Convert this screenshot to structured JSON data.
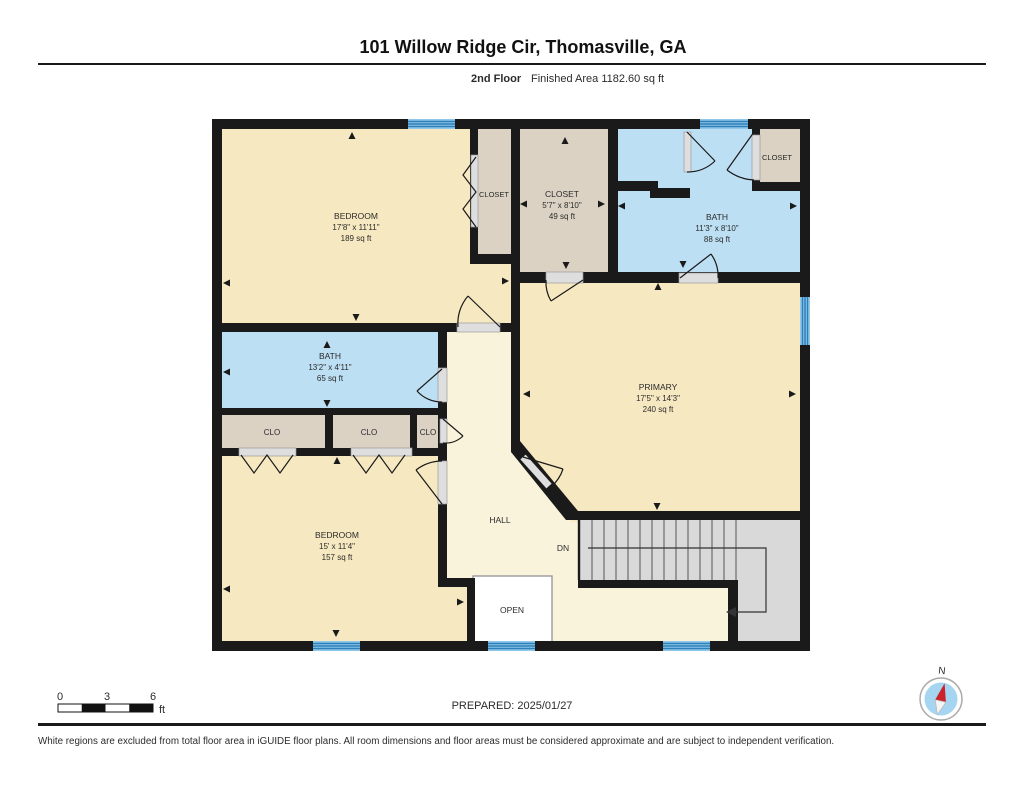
{
  "header": {
    "title": "101 Willow Ridge Cir, Thomasville, GA",
    "floor_label": "2nd Floor",
    "area_label": "Finished Area 1182.60 sq ft"
  },
  "rooms": {
    "bedroom1": {
      "name": "BEDROOM",
      "dims": "17'8\" x 11'11\"",
      "area": "189 sq ft"
    },
    "closet1": {
      "name": "CLOSET"
    },
    "closet2": {
      "name": "CLOSET",
      "dims": "5'7\" x 8'10\"",
      "area": "49 sq ft"
    },
    "bath1": {
      "name": "BATH",
      "dims": "11'3\" x 8'10\"",
      "area": "88 sq ft"
    },
    "closet3": {
      "name": "CLOSET"
    },
    "bath2": {
      "name": "BATH",
      "dims": "13'2\" x 4'11\"",
      "area": "65 sq ft"
    },
    "clo1": {
      "name": "CLO"
    },
    "clo2": {
      "name": "CLO"
    },
    "clo3": {
      "name": "CLO"
    },
    "primary": {
      "name": "PRIMARY",
      "dims": "17'5\" x 14'3\"",
      "area": "240 sq ft"
    },
    "bedroom2": {
      "name": "BEDROOM",
      "dims": "15' x 11'4\"",
      "area": "157 sq ft"
    },
    "hall": {
      "name": "HALL"
    },
    "open": {
      "name": "OPEN"
    },
    "stairs": {
      "label": "DN"
    }
  },
  "scale_bar": {
    "tick0": "0",
    "tick1": "3",
    "tick2": "6",
    "unit": "ft"
  },
  "prepared": "PREPARED: 2025/01/27",
  "compass": {
    "label": "N"
  },
  "footer": "White regions are excluded from total floor area in iGUIDE floor plans. All room dimensions and floor areas must be considered approximate and are subject to independent verification.",
  "colors": {
    "wall": "#1a1a1a",
    "room": "#F6E8C0",
    "hall": "#FAF3DB",
    "bath": "#BDDFF4",
    "closet": "#DBD2C3",
    "stairs": "#D9D9D9",
    "window_base": "#8FC8EA",
    "window_stripe": "#2F80B8",
    "needle": "#CC2229",
    "compass_face": "#A5D5F0"
  }
}
